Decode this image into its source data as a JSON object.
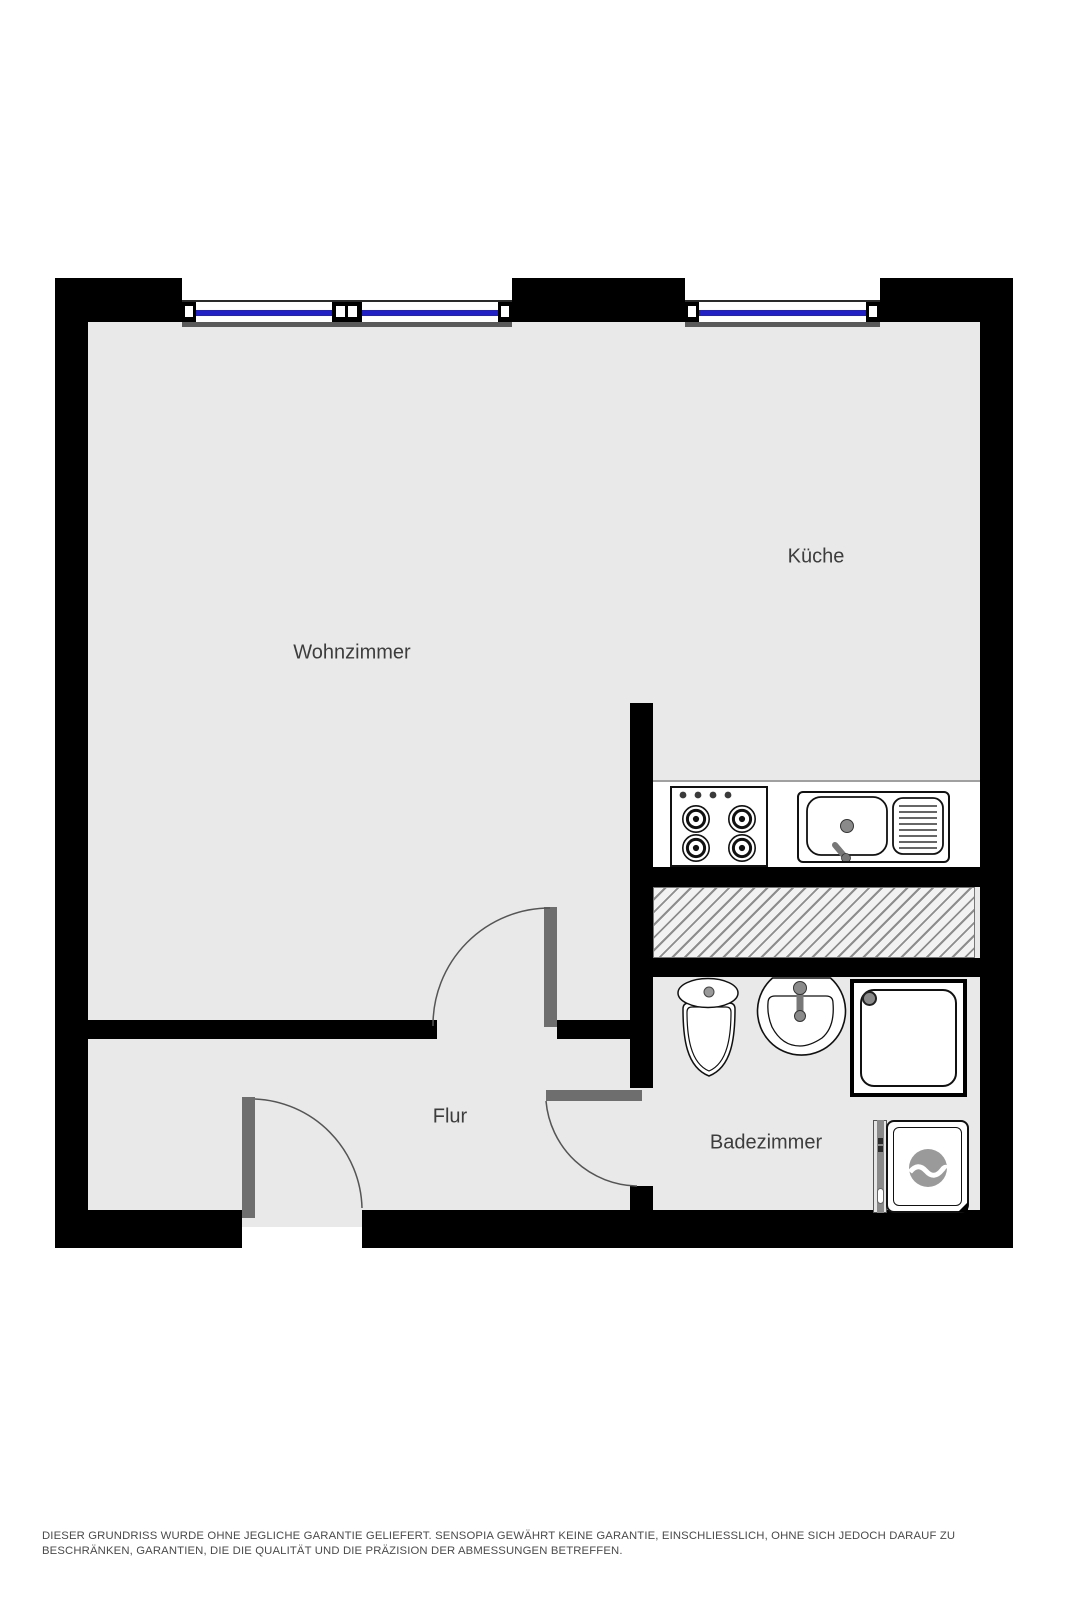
{
  "rooms": {
    "living": {
      "name": "Wohnzimmer"
    },
    "kitchen": {
      "name": "Küche"
    },
    "hall": {
      "name": "Flur"
    },
    "bath": {
      "name": "Badezimmer"
    }
  },
  "fixtures": {
    "stove": "stove-4-burners",
    "kitchen_sink": "kitchen-sink-with-drainboard",
    "toilet": "toilet",
    "washbasin": "washbasin",
    "shower": "shower",
    "washing_machine": "washing-machine"
  },
  "colors": {
    "wall": "#000000",
    "floor": "#e9e9e9",
    "window_glass": "#2222c4",
    "door_leaf": "#6e6e6e",
    "fixture_outline": "#111111",
    "room_label_text": "#3d3d3d",
    "disclaimer_text": "#4a4a4a",
    "hatch_line": "#8d8d8d"
  },
  "disclaimer": "DIESER GRUNDRISS WURDE OHNE JEGLICHE GARANTIE GELIEFERT. SENSOPIA GEWÄHRT KEINE GARANTIE, EINSCHLIESSLICH, OHNE SICH JEDOCH DARAUF ZU BESCHRÄNKEN, GARANTIEN, DIE DIE QUALITÄT UND DIE PRÄZISION DER ABMESSUNGEN BETREFFEN."
}
